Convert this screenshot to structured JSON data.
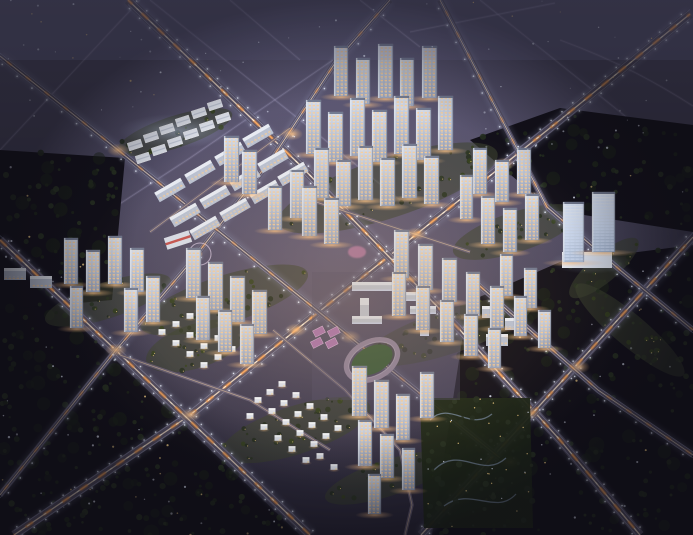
{
  "meta": {
    "kind": "architectural-aerial-rendering",
    "view": "aerial-oblique-dusk",
    "canvas": {
      "width": 693,
      "height": 535
    },
    "description": "Night aerial rendering of a residential masterplan: lit high-rise tower clusters, mid-rise slab apartments, villa rows, school with running track and courts, retail strip, twin office towers, landscaped parks, diagonal arterial roads with light trails, surrounded by dark forest parcels and bare land."
  },
  "palette": {
    "ground_top": "#5b5875",
    "ground_mid": "#454258",
    "ground_low": "#2b2839",
    "bare_line": "#9b95b8",
    "forest_fill": "#121019",
    "forest_patch": "#1c2617",
    "road_fill": "#575166",
    "road_edge": "#aab4d8",
    "road_center": "#ffe9cf",
    "trail_orange": "#ff9b45",
    "trail_white": "#fff3e0",
    "lamp": "#e9efff",
    "facade_top": "#d6dce8",
    "facade_mid": "#b6bfd2",
    "facade_low": "#98a2ba",
    "facade_edge": "#f0f4fb",
    "roof": "#747c92",
    "window_warm": "#ffce92",
    "window_cool": "#d7e5ff",
    "slab_body": "#b9c1d2",
    "slab_roof": "#e8ecf4",
    "villa_body": "#dde2ec",
    "villa_roof": "#f2f5f9",
    "commercial_white": "#e9edf6",
    "school_body": "#b9c0cf",
    "school_roof": "#d8dde8",
    "landscape": "#3c4430",
    "tree_a": "#1e271a",
    "tree_b": "#232d1e",
    "tree_c": "#2a3522",
    "warm_dot": "#ffd98a",
    "track_field": "#3e5a3e",
    "track_ring": "#8d8098",
    "court": "#a873aa",
    "pink_accent": "#e08ab8",
    "red_accent": "#c2453f",
    "glow_warm": "#ffc487",
    "glow_cool": "#cfe0ff",
    "vignette": "#0d0c14"
  },
  "scene": {
    "roads": {
      "major": [
        {
          "id": "arterial-sw-ne-spine",
          "path": "M14,535 L190,415 L296,330 L560,120 L690,14"
        },
        {
          "id": "arterial-nw-se-west",
          "path": "M0,240 L310,535"
        },
        {
          "id": "arterial-nw-se-center",
          "path": "M128,0 L300,165 L460,330 L560,440 L640,535"
        },
        {
          "id": "arterial-sw-ne-east",
          "path": "M421,535 L563,380 L693,237"
        }
      ],
      "medium": [
        {
          "id": "road-west-diagonal",
          "path": "M0,495 L116,350 L190,263 L273,157 L337,60 L390,0"
        },
        {
          "id": "road-north-loop",
          "path": "M0,56 L118,150 L350,337 L500,458"
        },
        {
          "id": "road-east-loop",
          "path": "M440,0 L547,207 L620,270 L693,330"
        },
        {
          "id": "road-east-belt",
          "path": "M473,280 L598,390 L693,455"
        }
      ],
      "minor": [
        {
          "id": "lane-villa-north",
          "path": "M120,355 L250,400 L330,450"
        },
        {
          "id": "lane-villa-east",
          "path": "M273,330 L345,390 L400,450 L412,505 L405,535"
        },
        {
          "id": "lane-school-north",
          "path": "M316,202 L470,252"
        },
        {
          "id": "lane-estate",
          "path": "M150,232 L290,128"
        }
      ]
    },
    "faint_lines": [
      {
        "path": "M0,282 L190,158 L333,60"
      },
      {
        "path": "M150,0 L400,200"
      },
      {
        "path": "M360,0 L420,47"
      },
      {
        "path": "M410,32 L555,3"
      },
      {
        "path": "M480,0 L690,168"
      },
      {
        "path": "M560,40 C620,62 660,85 693,106"
      },
      {
        "path": "M620,535 L693,450"
      },
      {
        "path": "M0,150 L140,0"
      },
      {
        "path": "M230,0 L300,60"
      }
    ],
    "intersection_glows": [
      [
        190,
        415
      ],
      [
        296,
        330
      ],
      [
        416,
        234
      ],
      [
        530,
        413
      ],
      [
        579,
        367
      ],
      [
        504,
        164
      ],
      [
        116,
        350
      ],
      [
        118,
        150
      ],
      [
        292,
        134
      ],
      [
        350,
        337
      ],
      [
        510,
        462
      ]
    ],
    "forest_zones": [
      {
        "id": "forest-southwest",
        "poly": [
          [
            0,
            250
          ],
          [
            300,
            535
          ],
          [
            0,
            535
          ]
        ],
        "trees": 150,
        "specks": 42
      },
      {
        "id": "forest-west",
        "poly": [
          [
            0,
            150
          ],
          [
            125,
            158
          ],
          [
            112,
            300
          ],
          [
            0,
            310
          ]
        ],
        "trees": 55,
        "specks": 10
      },
      {
        "id": "forest-southeast",
        "poly": [
          [
            468,
            302
          ],
          [
            560,
            262
          ],
          [
            693,
            245
          ],
          [
            693,
            535
          ],
          [
            432,
            535
          ]
        ],
        "trees": 130,
        "specks": 38
      },
      {
        "id": "forest-northeast",
        "poly": [
          [
            470,
            140
          ],
          [
            560,
            108
          ],
          [
            693,
            125
          ],
          [
            693,
            232
          ],
          [
            552,
            210
          ]
        ],
        "trees": 45,
        "specks": 14
      }
    ],
    "bare_zones": [
      {
        "rect": [
          0,
          0,
          360,
          148
        ],
        "specks": 36
      },
      {
        "rect": [
          360,
          0,
          333,
          92
        ],
        "specks": 20
      },
      {
        "rect": [
          470,
          95,
          200,
          60
        ],
        "specks": 10
      }
    ],
    "landscape_ellipses": [
      [
        388,
        188,
        115,
        30,
        -18
      ],
      [
        516,
        232,
        66,
        20,
        -18
      ],
      [
        108,
        300,
        66,
        18,
        -18
      ],
      [
        224,
        300,
        88,
        24,
        -18
      ],
      [
        448,
        332,
        88,
        22,
        -18
      ],
      [
        388,
        478,
        66,
        18,
        -18
      ],
      [
        296,
        430,
        78,
        24,
        -18
      ],
      [
        604,
        268,
        44,
        14,
        -40
      ],
      [
        630,
        330,
        70,
        16,
        40
      ],
      [
        196,
        346,
        52,
        22,
        -18
      ],
      [
        175,
        132,
        60,
        16,
        -18
      ]
    ],
    "park_southeast": {
      "poly": [
        [
          420,
          398
        ],
        [
          530,
          398
        ],
        [
          533,
          528
        ],
        [
          424,
          528
        ]
      ],
      "paths": [
        "M430,420 C450,400 470,432 492,414",
        "M434,470 C460,444 482,480 506,458",
        "M444,506 C470,486 496,516 516,494"
      ],
      "trees": 48,
      "lights": 30
    },
    "clusters": [
      {
        "id": "cluster-top-center",
        "towers": [
          [
            334,
            46,
            14,
            50
          ],
          [
            356,
            58,
            14,
            46
          ],
          [
            378,
            44,
            15,
            54
          ],
          [
            400,
            58,
            14,
            48
          ],
          [
            422,
            46,
            15,
            52
          ],
          [
            306,
            100,
            15,
            54
          ],
          [
            328,
            112,
            15,
            50
          ],
          [
            350,
            98,
            15,
            58
          ],
          [
            372,
            110,
            15,
            52
          ],
          [
            394,
            96,
            15,
            58
          ],
          [
            416,
            108,
            15,
            52
          ],
          [
            438,
            96,
            15,
            54
          ],
          [
            314,
            148,
            15,
            50
          ],
          [
            336,
            160,
            15,
            46
          ],
          [
            358,
            146,
            15,
            54
          ],
          [
            380,
            158,
            15,
            48
          ],
          [
            402,
            144,
            15,
            54
          ],
          [
            424,
            156,
            15,
            48
          ],
          [
            224,
            136,
            15,
            46
          ],
          [
            242,
            150,
            15,
            44
          ],
          [
            290,
            170,
            14,
            48
          ],
          [
            268,
            186,
            14,
            44
          ],
          [
            302,
            186,
            15,
            50
          ],
          [
            324,
            198,
            15,
            46
          ]
        ]
      },
      {
        "id": "cluster-top-right",
        "towers": [
          [
            473,
            148,
            14,
            46
          ],
          [
            495,
            160,
            14,
            42
          ],
          [
            517,
            148,
            14,
            46
          ],
          [
            460,
            175,
            13,
            44
          ],
          [
            481,
            196,
            14,
            48
          ],
          [
            503,
            208,
            14,
            44
          ],
          [
            525,
            194,
            14,
            46
          ]
        ]
      },
      {
        "id": "cluster-east",
        "towers": [
          [
            394,
            230,
            15,
            48
          ],
          [
            418,
            244,
            15,
            46
          ],
          [
            442,
            258,
            15,
            44
          ],
          [
            466,
            272,
            14,
            44
          ],
          [
            490,
            286,
            14,
            42
          ],
          [
            392,
            272,
            14,
            44
          ],
          [
            416,
            286,
            14,
            44
          ],
          [
            440,
            300,
            14,
            42
          ],
          [
            464,
            314,
            14,
            42
          ],
          [
            488,
            328,
            13,
            40
          ],
          [
            500,
            254,
            13,
            42
          ],
          [
            524,
            268,
            13,
            40
          ],
          [
            514,
            296,
            13,
            40
          ],
          [
            538,
            310,
            13,
            38
          ]
        ]
      },
      {
        "id": "cluster-left",
        "towers": [
          [
            64,
            238,
            14,
            46
          ],
          [
            86,
            250,
            14,
            42
          ],
          [
            108,
            236,
            14,
            48
          ],
          [
            130,
            248,
            14,
            44
          ],
          [
            70,
            286,
            13,
            42
          ],
          [
            124,
            288,
            14,
            44
          ],
          [
            146,
            276,
            14,
            46
          ]
        ]
      },
      {
        "id": "cluster-center",
        "towers": [
          [
            186,
            248,
            15,
            50
          ],
          [
            208,
            262,
            15,
            48
          ],
          [
            230,
            276,
            15,
            46
          ],
          [
            252,
            290,
            15,
            44
          ],
          [
            196,
            296,
            14,
            44
          ],
          [
            218,
            310,
            14,
            42
          ],
          [
            240,
            324,
            14,
            40
          ]
        ]
      },
      {
        "id": "cluster-south",
        "towers": [
          [
            352,
            366,
            15,
            50
          ],
          [
            374,
            380,
            15,
            48
          ],
          [
            396,
            394,
            14,
            46
          ],
          [
            420,
            372,
            14,
            46
          ],
          [
            358,
            420,
            14,
            46
          ],
          [
            380,
            434,
            14,
            44
          ],
          [
            402,
            448,
            13,
            42
          ],
          [
            368,
            474,
            13,
            40
          ]
        ]
      }
    ],
    "offices": {
      "towers": [
        [
          563,
          202,
          21,
          60
        ],
        [
          592,
          192,
          23,
          60
        ]
      ],
      "podium": [
        562,
        252,
        50,
        16
      ]
    },
    "midrise_estate": {
      "angle": -30,
      "size": [
        30,
        11
      ],
      "slabs": [
        [
          170,
          190
        ],
        [
          200,
          172
        ],
        [
          230,
          154
        ],
        [
          258,
          136
        ],
        [
          185,
          215
        ],
        [
          215,
          197
        ],
        [
          245,
          179
        ],
        [
          273,
          161
        ],
        [
          205,
          228
        ],
        [
          235,
          210
        ],
        [
          265,
          192
        ],
        [
          293,
          174
        ]
      ]
    },
    "small_slabs": [
      [
        4,
        268,
        22,
        12
      ],
      [
        30,
        276,
        22,
        12
      ],
      [
        482,
        306,
        22,
        12
      ],
      [
        505,
        318,
        22,
        12
      ],
      [
        486,
        334,
        22,
        12
      ]
    ],
    "commercial": {
      "angle": -18,
      "size": [
        14,
        8
      ],
      "units": [
        [
          135,
          145
        ],
        [
          151,
          137
        ],
        [
          167,
          129
        ],
        [
          183,
          121
        ],
        [
          199,
          113
        ],
        [
          215,
          105
        ],
        [
          143,
          158
        ],
        [
          159,
          150
        ],
        [
          175,
          142
        ],
        [
          191,
          134
        ],
        [
          207,
          126
        ],
        [
          223,
          118
        ]
      ]
    },
    "red_building": {
      "cx": 178,
      "cy": 240,
      "w": 26,
      "h": 12,
      "angle": -18
    },
    "plaza_circle": {
      "cx": 200,
      "cy": 254,
      "r": 11
    },
    "school": {
      "ground": [
        [
          312,
          272
        ],
        [
          460,
          272
        ],
        [
          460,
          400
        ],
        [
          312,
          400
        ]
      ],
      "buildings": [
        [
          352,
          282,
          40,
          9
        ],
        [
          396,
          292,
          34,
          9
        ],
        [
          360,
          298,
          9,
          20
        ],
        [
          410,
          306,
          26,
          8
        ],
        [
          352,
          316,
          30,
          8
        ],
        [
          420,
          318,
          9,
          18
        ]
      ],
      "track": {
        "cx": 372,
        "cy": 360,
        "rx": 27,
        "ry": 18,
        "angle": -27
      },
      "courts": {
        "angle": -27,
        "size": [
          11,
          7
        ],
        "cells": [
          [
            322,
            328
          ],
          [
            335,
            335
          ],
          [
            315,
            337
          ],
          [
            328,
            344
          ]
        ]
      },
      "pink_plaza": [
        357,
        252
      ]
    },
    "villas": {
      "zone_a": [
        [
          162,
          332
        ],
        [
          176,
          343
        ],
        [
          190,
          354
        ],
        [
          204,
          365
        ],
        [
          176,
          324
        ],
        [
          190,
          335
        ],
        [
          204,
          346
        ],
        [
          218,
          357
        ],
        [
          190,
          316
        ],
        [
          204,
          327
        ],
        [
          218,
          338
        ],
        [
          232,
          349
        ]
      ],
      "zone_b": [
        [
          258,
          400
        ],
        [
          272,
          411
        ],
        [
          286,
          422
        ],
        [
          300,
          433
        ],
        [
          314,
          444
        ],
        [
          270,
          392
        ],
        [
          284,
          403
        ],
        [
          298,
          414
        ],
        [
          312,
          425
        ],
        [
          326,
          436
        ],
        [
          282,
          384
        ],
        [
          296,
          395
        ],
        [
          310,
          406
        ],
        [
          324,
          417
        ],
        [
          338,
          428
        ],
        [
          250,
          416
        ],
        [
          264,
          427
        ],
        [
          278,
          438
        ],
        [
          292,
          449
        ],
        [
          306,
          460
        ],
        [
          320,
          456
        ],
        [
          334,
          467
        ]
      ]
    }
  }
}
